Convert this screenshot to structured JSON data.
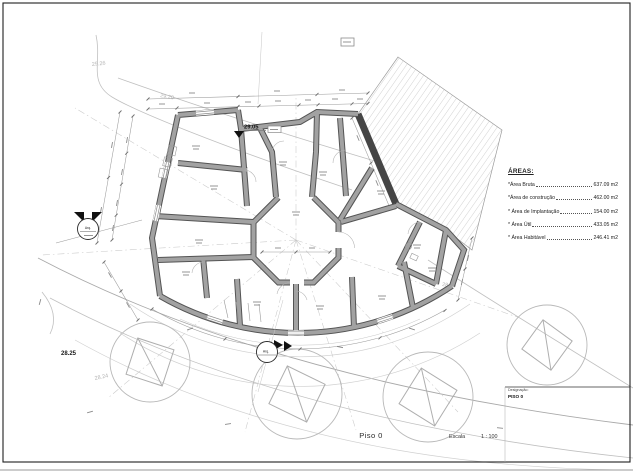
{
  "areas_table": {
    "title": "ÁREAS:",
    "items": [
      {
        "label": "*Área Bruta",
        "value": "637.09 m2"
      },
      {
        "label": "*Área de construção",
        "value": "462.00 m2"
      },
      {
        "label": "* Área de Implantação",
        "value": "154.00 m2"
      },
      {
        "label": "* Área Útil",
        "value": "433.05 m2"
      },
      {
        "label": "* Área Habitável",
        "value": "246.41 m2"
      }
    ]
  },
  "footer": {
    "plan_title": "Piso 0",
    "scale_label": "Escala",
    "scale_value": "1 : 100"
  },
  "title_block": {
    "label": "Designação:",
    "value": "PISO 0"
  },
  "plan": {
    "level_mark": "29.05",
    "spot_elevation": "28.25",
    "contour_labels": [
      "29.26",
      "29.20",
      "28.70",
      "28.24"
    ],
    "section_marker_label": "Arq."
  }
}
